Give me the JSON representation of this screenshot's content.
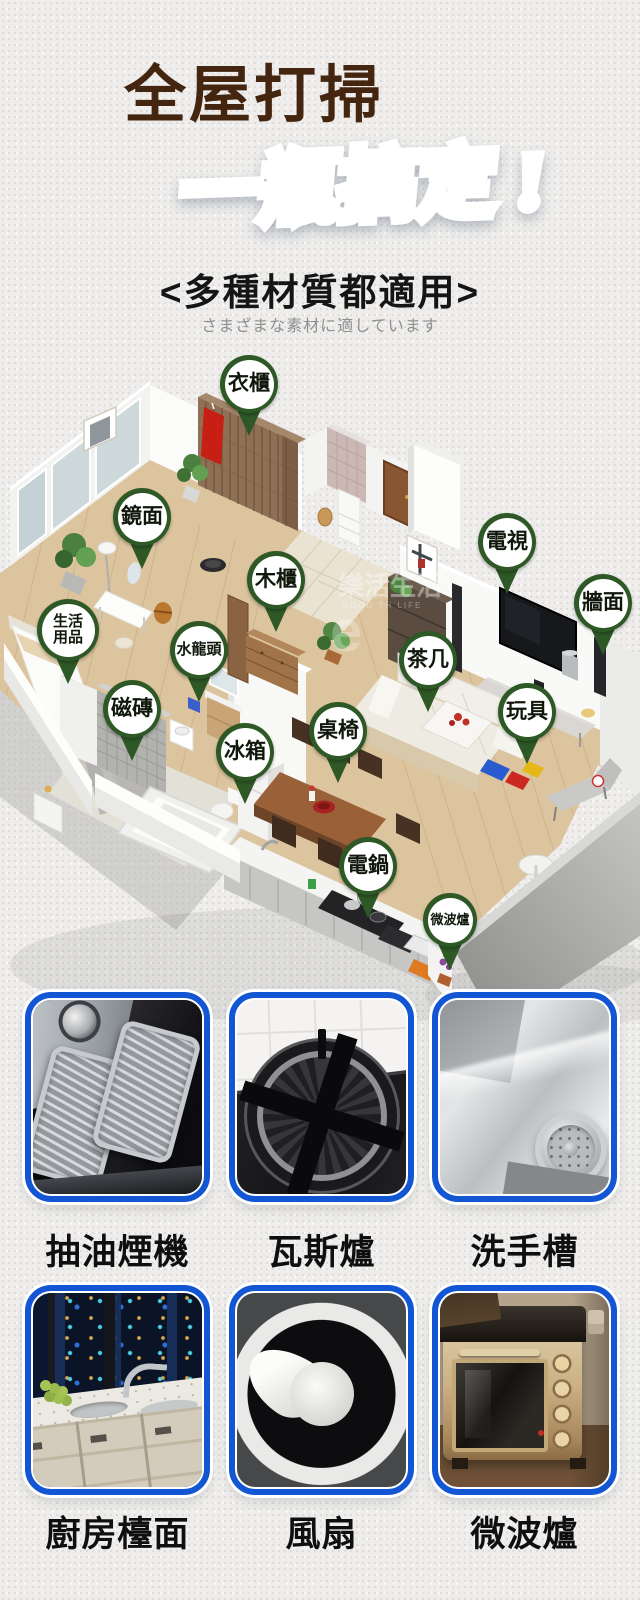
{
  "header": {
    "title": "全屋打掃",
    "slogan": "一瓶搞定 !",
    "tagline": "<多種材質都適用>",
    "tagline_jp": "さまざまな素材に適しています"
  },
  "colors": {
    "title_brown": "#44250f",
    "accent_blue_dark": "#1450bc",
    "accent_blue_light": "#8ec8fa",
    "pin_green": "#2e5926",
    "photo_border": "#1356d4"
  },
  "floorplan": {
    "watermark": "樂活生活",
    "watermark_sub": "GOOD TH LIFE",
    "pins": [
      {
        "label": "衣櫃",
        "x": 249,
        "y": 384
      },
      {
        "label": "鏡面",
        "x": 142,
        "y": 517
      },
      {
        "label": "電視",
        "x": 507,
        "y": 542
      },
      {
        "label": "木櫃",
        "x": 276,
        "y": 580
      },
      {
        "label": "牆面",
        "x": 603,
        "y": 603
      },
      {
        "label": "生活用品",
        "x": 68,
        "y": 630,
        "d": 62,
        "fs": 15,
        "wrap": 34
      },
      {
        "label": "水龍頭",
        "x": 199,
        "y": 650,
        "fs": 15
      },
      {
        "label": "茶几",
        "x": 428,
        "y": 660
      },
      {
        "label": "磁磚",
        "x": 132,
        "y": 709
      },
      {
        "label": "玩具",
        "x": 527,
        "y": 712
      },
      {
        "label": "桌椅",
        "x": 338,
        "y": 731
      },
      {
        "label": "冰箱",
        "x": 245,
        "y": 752
      },
      {
        "label": "電鍋",
        "x": 368,
        "y": 866
      },
      {
        "label": "微波爐",
        "x": 450,
        "y": 920,
        "d": 54,
        "fs": 13
      }
    ]
  },
  "gallery": {
    "items": [
      {
        "label": "抽油煙機",
        "art": "range-hood"
      },
      {
        "label": "瓦斯爐",
        "art": "gas-stove"
      },
      {
        "label": "洗手槽",
        "art": "sink"
      },
      {
        "label": "廚房檯面",
        "art": "kitchen-counter"
      },
      {
        "label": "風扇",
        "art": "fan"
      },
      {
        "label": "微波爐",
        "art": "microwave"
      }
    ]
  }
}
